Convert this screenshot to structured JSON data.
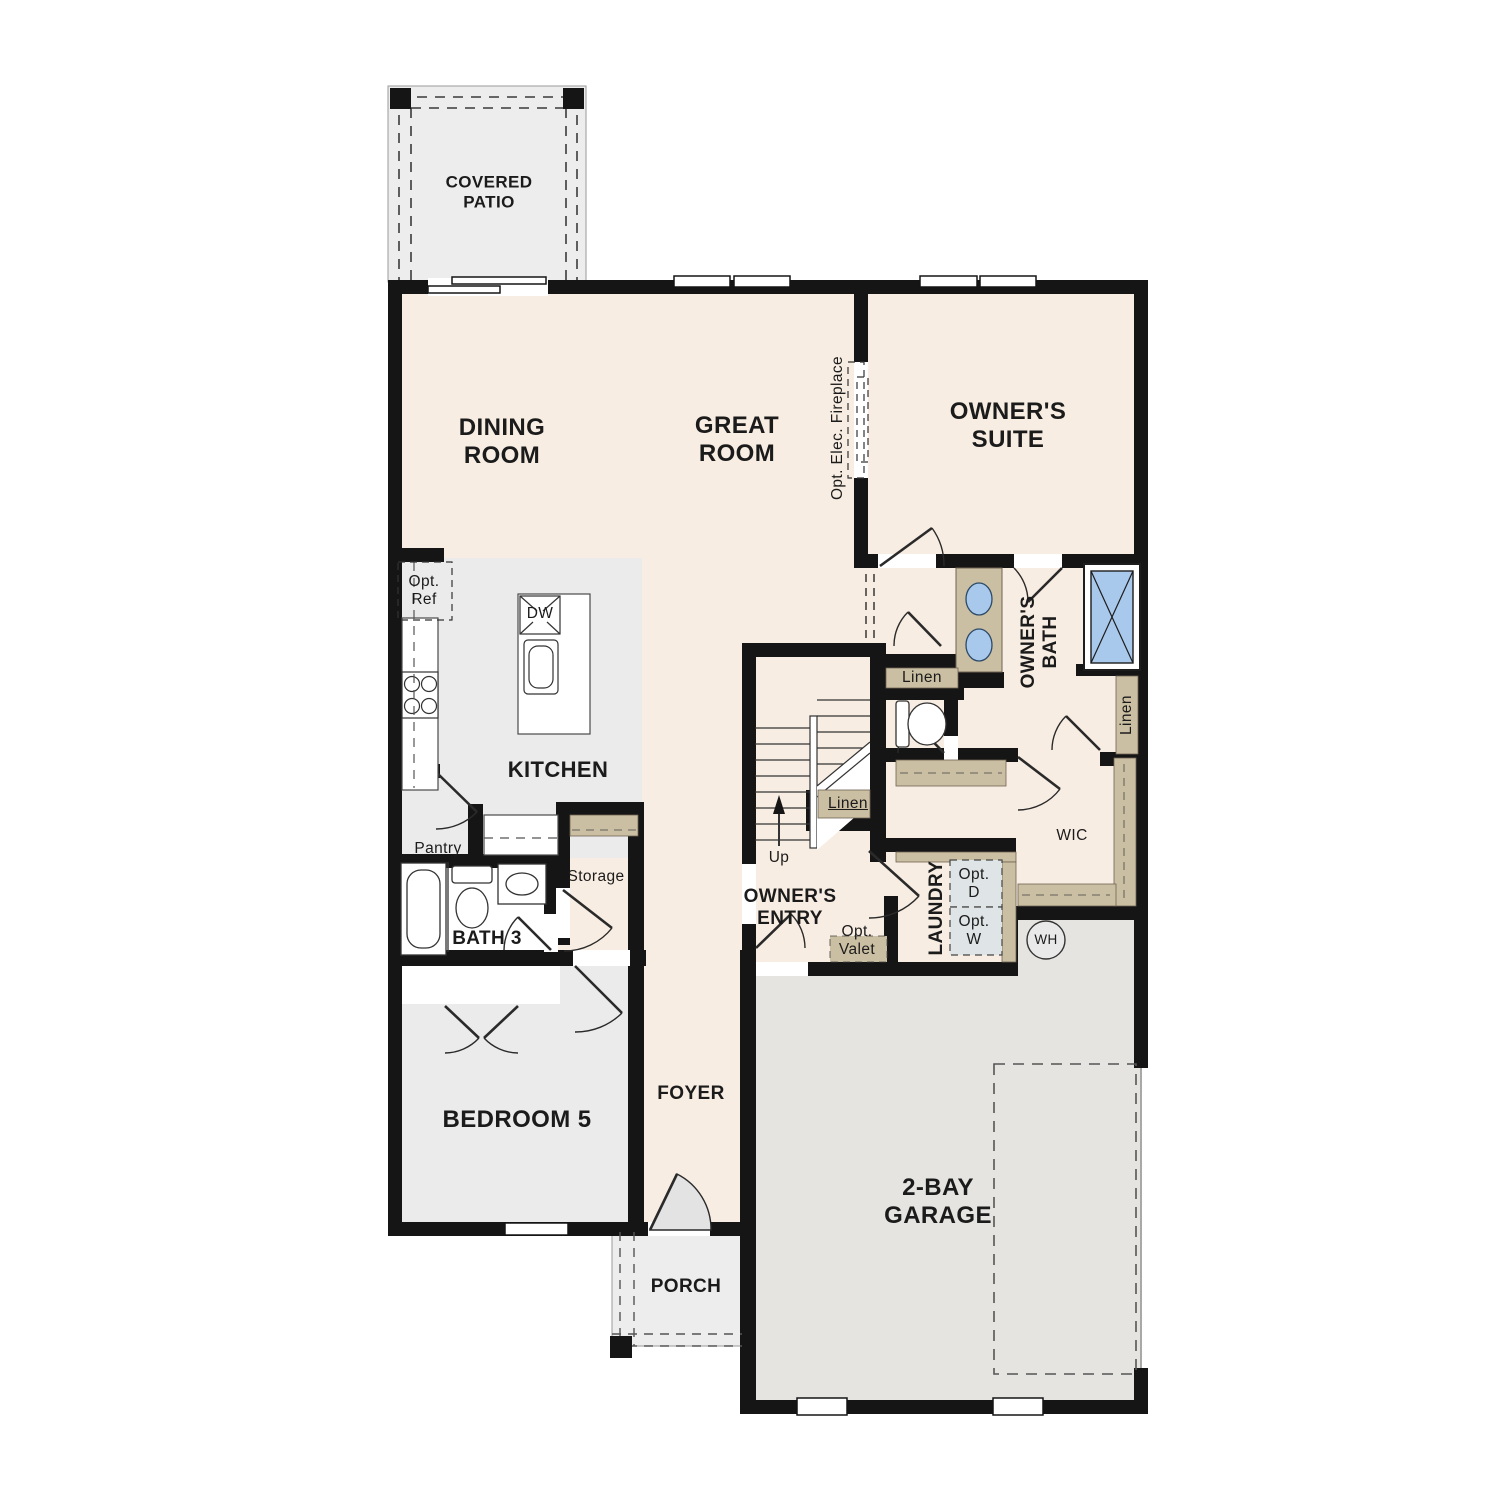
{
  "plan_title": "First floor plan",
  "rooms": {
    "covered_patio": "COVERED PATIO",
    "dining_room": "DINING ROOM",
    "great_room": "GREAT ROOM",
    "owners_suite": "OWNER'S SUITE",
    "kitchen": "KITCHEN",
    "owners_bath": "OWNER'S BATH",
    "bath_3": "BATH 3",
    "bedroom_5": "BEDROOM 5",
    "foyer": "FOYER",
    "porch": "PORCH",
    "garage": "2-BAY GARAGE",
    "owners_entry": "OWNER'S ENTRY",
    "laundry": "LAUNDRY",
    "wic": "WIC"
  },
  "labels": {
    "opt_elec_fireplace": "Opt. Elec. Fireplace",
    "opt_ref": "Opt. Ref",
    "dw": "DW",
    "pantry": "Pantry",
    "storage": "Storage",
    "linen_bath": "Linen",
    "linen_stairs": "Linen",
    "linen_right": "Linen",
    "up": "Up",
    "opt_valet": "Opt. Valet",
    "opt_d": "Opt. D",
    "opt_w": "Opt. W",
    "wh": "WH"
  },
  "colors": {
    "floor_cream": "#f8ede2",
    "room_gray": "#ebebeb",
    "garage_gray": "#e5e4e1",
    "patio_gray": "#ededed",
    "shelf_tan": "#cbbfa3",
    "fixture_blue": "#a9c9ec",
    "appliance_gray_blue": "#dfe4e6",
    "wall_black": "#151515"
  }
}
